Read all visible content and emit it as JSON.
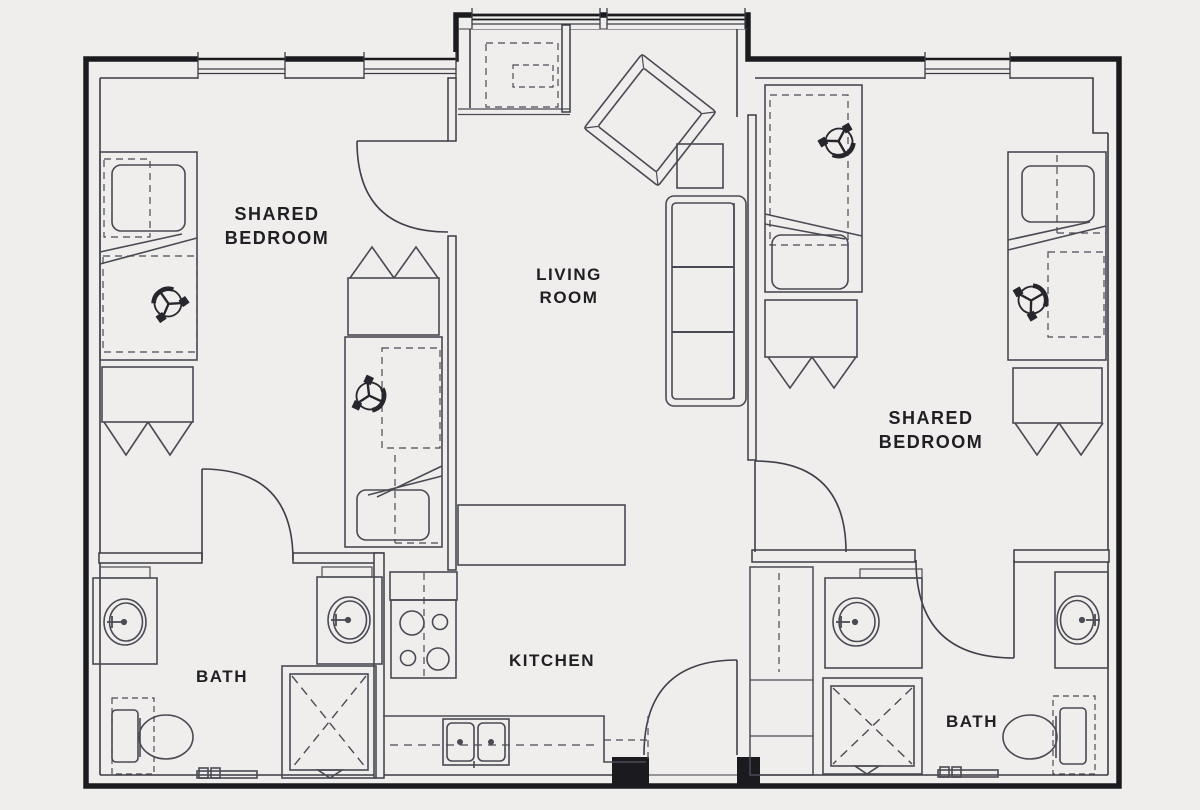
{
  "floorplan": {
    "title_visible_text": [],
    "colors": {
      "background": "#f0eeec",
      "exterior_wall": "#1b1b1f",
      "interior_wall": "#3c3c45",
      "furniture_line": "#4a4a54",
      "dashed_line": "#6a6a74",
      "label_text": "#202024"
    },
    "rooms": [
      {
        "id": "shared-bedroom-left",
        "lines": [
          "SHARED",
          "BEDROOM"
        ]
      },
      {
        "id": "living-room",
        "lines": [
          "LIVING",
          "ROOM"
        ]
      },
      {
        "id": "shared-bedroom-right",
        "lines": [
          "SHARED",
          "BEDROOM"
        ]
      },
      {
        "id": "kitchen",
        "lines": [
          "KITCHEN"
        ]
      },
      {
        "id": "bath-left",
        "lines": [
          "BATH"
        ]
      },
      {
        "id": "bath-right",
        "lines": [
          "BATH"
        ]
      }
    ],
    "fixtures": [
      "bed-icon",
      "pillow-icon",
      "desk-chair-icon",
      "wardrobe-icon",
      "sofa-icon",
      "lounge-chair-icon",
      "side-table-icon",
      "console-table-icon",
      "stove-icon",
      "kitchen-sink-icon",
      "bathroom-sink-icon",
      "shower-icon",
      "toilet-icon",
      "towel-bar-icon",
      "door-swing-icon",
      "window-icon",
      "closet-icon"
    ]
  }
}
